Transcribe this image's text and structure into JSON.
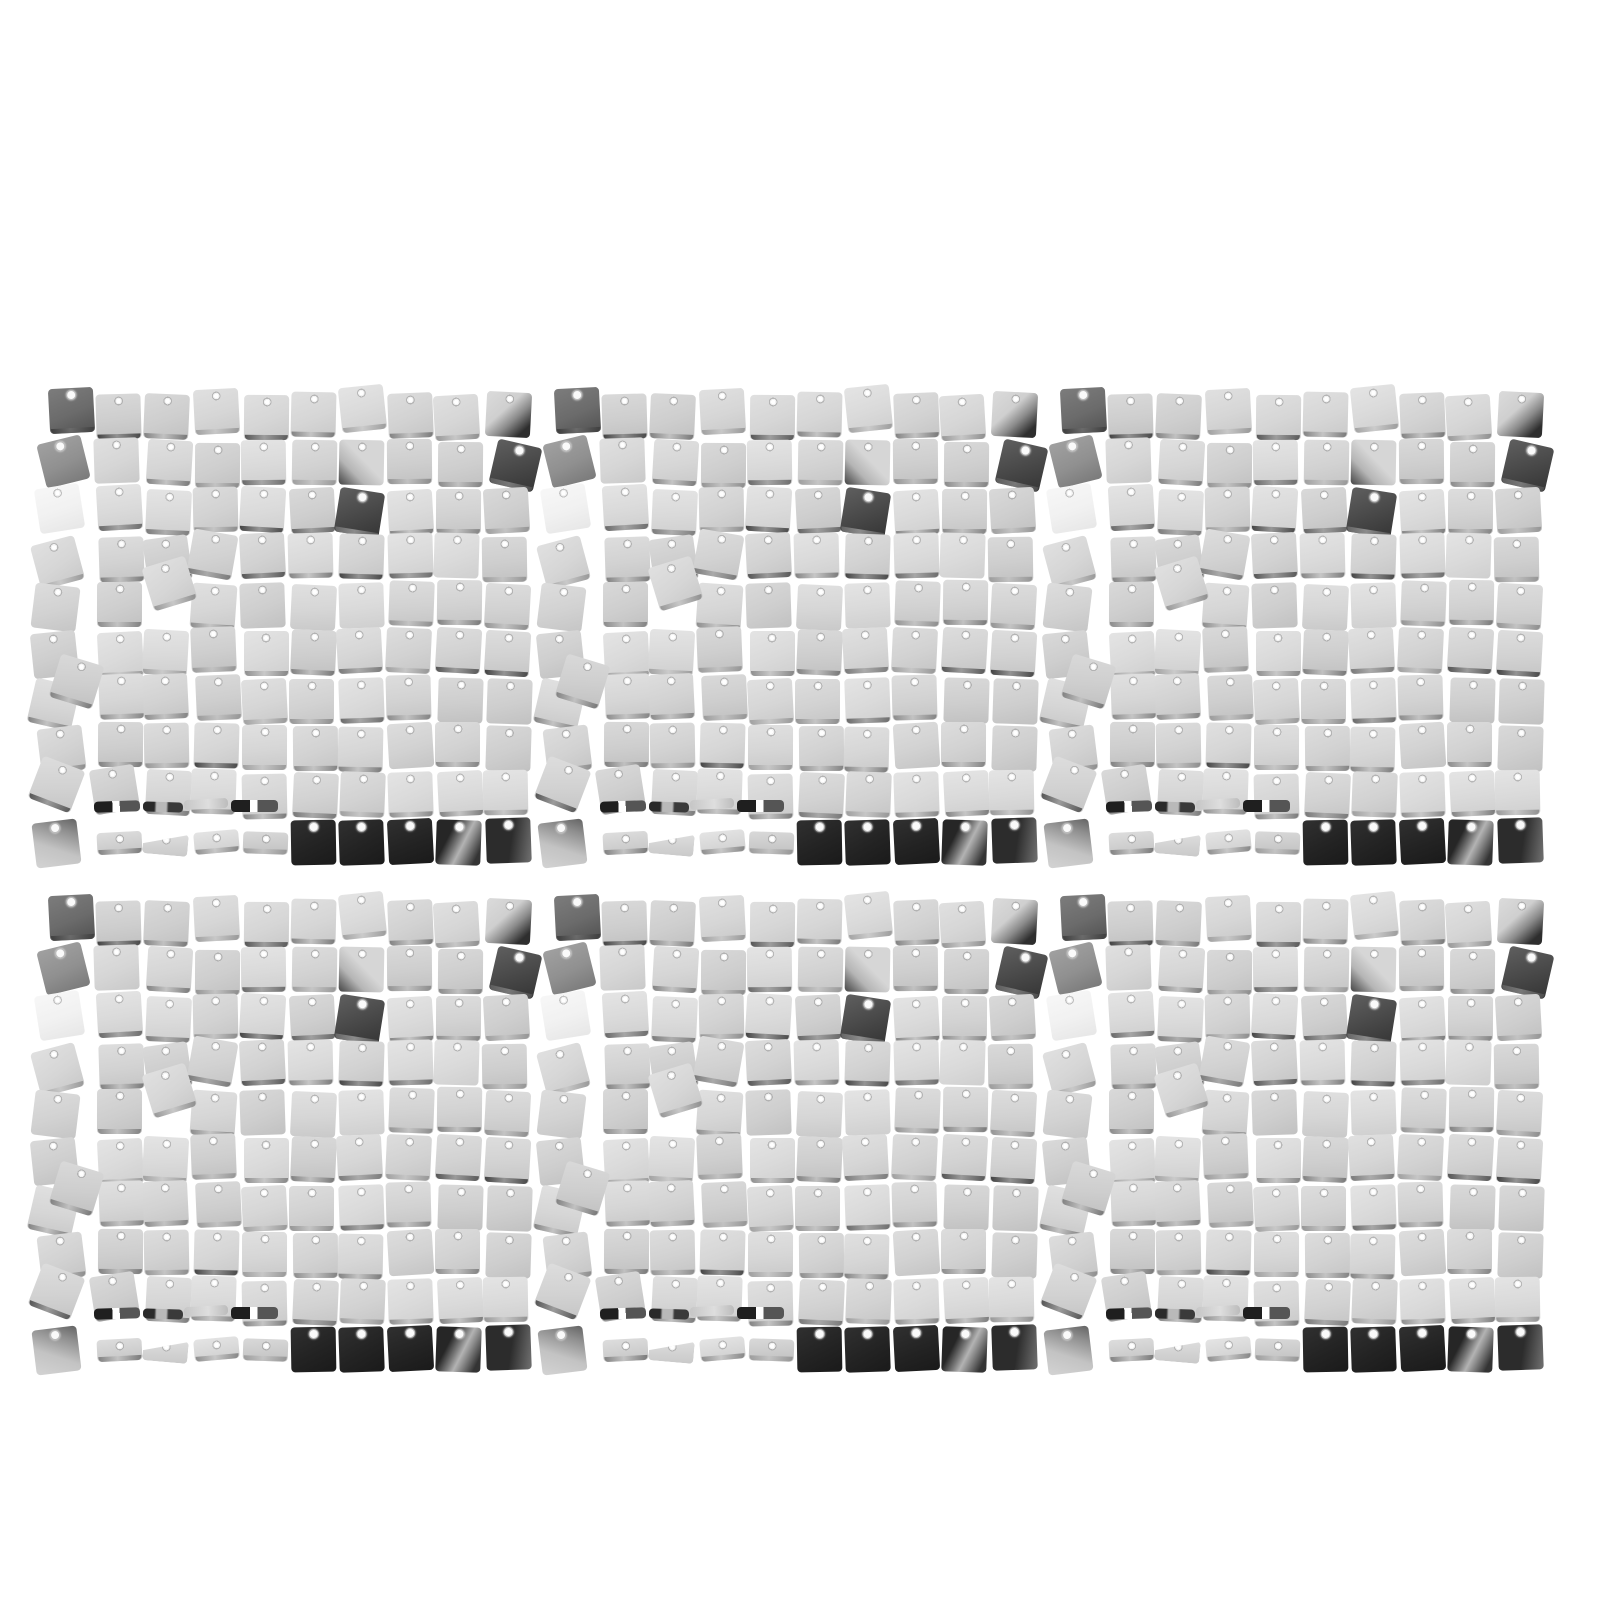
{
  "scene": {
    "subject": "six-silver-square-sequin-shimmer-wall-panels",
    "background_color": "#ffffff",
    "panels": {
      "count": 6,
      "arrangement_rows": 2,
      "arrangement_cols": 3,
      "origins_x": [
        48,
        554,
        1060
      ],
      "origins_y": [
        393,
        900
      ],
      "sequin_rows": 10,
      "sequin_cols": 10,
      "col_pitch": 48.5,
      "row_pitch": 47.3,
      "sequin_size": 45,
      "half_piece_height": 22,
      "sliver_height": 11
    },
    "colors": {
      "light_tints": [
        [
          "#e0e0e0",
          "#d6d6d6",
          "#c9c9c9"
        ],
        [
          "#dddddd",
          "#d2d2d2",
          "#c5c5c5"
        ],
        [
          "#e4e4e4",
          "#dadada",
          "#cfcfcf"
        ],
        [
          "#d9d9d9",
          "#cecece",
          "#c1c1c1"
        ]
      ],
      "white_tint": [
        "#f7f7f7",
        "#f1f1f1",
        "#e7e7e7"
      ],
      "mid_gray": [
        "#a0a0a0",
        "#909090",
        "#7a7a7a"
      ],
      "dark_gray": [
        "#7c7c7c",
        "#6b6b6b",
        "#525252"
      ],
      "dark_gray2": [
        "#5f5f5f",
        "#484848",
        "#353535"
      ],
      "black": [
        "#303030",
        "#232323",
        "#1a1a1a"
      ],
      "black_gradient": [
        "#262626",
        "#7e7e7e",
        "#b3b3b3",
        "#8a8a8a",
        "#343434"
      ],
      "black_side": [
        "#2c2c2c",
        "#6a6a6a"
      ],
      "grad_bottom_right": [
        "#dbdbdb",
        "#cfcfcf",
        "#8a8a8a",
        "#2e2e2e"
      ],
      "grad_bottom_left": [
        "#454545",
        "#6f6f6f",
        "#b5b5b5",
        "#d6d6d6"
      ],
      "grad_top_dark": [
        "#636363",
        "#8f8f8f",
        "#c3c3c3",
        "#d3d3d3"
      ],
      "sliver_dark": [
        "#1f1f1f",
        "#555555",
        "#262626"
      ],
      "sliver_mix": [
        "#2a2a2a",
        "#b9b9b9",
        "#3a3a3a"
      ],
      "sliver_light": [
        "#c6c6c6",
        "#dedede",
        "#bcbcbc"
      ],
      "edge_silver": [
        "rgba(110,110,110,0.85)",
        "rgba(190,190,190,0.65)",
        "rgba(95,95,95,0.8)"
      ],
      "edge_dark": [
        "rgba(40,40,40,0.9)",
        "rgba(120,120,120,0.7)",
        "rgba(50,50,50,0.9)"
      ]
    },
    "special_cells": [
      {
        "r": 1,
        "c": 1,
        "t": "dark",
        "rot": -3,
        "dx": 1,
        "dy": -5
      },
      {
        "r": 2,
        "c": 1,
        "t": "mid",
        "rot": -14,
        "dx": -7,
        "dy": -1
      },
      {
        "r": 3,
        "c": 1,
        "t": "white",
        "rot": -9,
        "dx": -11,
        "dy": -2
      },
      {
        "r": 4,
        "c": 1,
        "t": "light",
        "rot": -15,
        "dx": -13,
        "dy": 5
      },
      {
        "r": 5,
        "c": 1,
        "t": "light",
        "rot": 7,
        "dx": -15,
        "dy": 3
      },
      {
        "r": 6,
        "c": 1,
        "t": "light",
        "rot": -6,
        "dx": -16,
        "dy": 2
      },
      {
        "r": 7,
        "c": 1,
        "t": "light",
        "rot": 13,
        "dx": -17,
        "dy": 5
      },
      {
        "r": 8,
        "c": 1,
        "t": "light",
        "rot": -7,
        "dx": -9,
        "dy": 3
      },
      {
        "r": 9,
        "c": 1,
        "t": "light",
        "rot": 21,
        "dx": -14,
        "dy": -9
      },
      {
        "r": 9,
        "c": 2,
        "t": "light",
        "rot": -9,
        "dx": -5,
        "dy": -4
      },
      {
        "r": 10,
        "c": 1,
        "t": "grad-top",
        "rot": -7,
        "dx": -14,
        "dy": 2
      },
      {
        "r": 1,
        "c": 4,
        "t": "light",
        "rot": -3,
        "dx": 0,
        "dy": -4
      },
      {
        "r": 1,
        "c": 7,
        "t": "light",
        "rot": -6,
        "dx": 1,
        "dy": -7
      },
      {
        "r": 1,
        "c": 10,
        "t": "grad-br",
        "rot": 3,
        "dx": 1,
        "dy": -1
      },
      {
        "r": 2,
        "c": 7,
        "t": "grad-bl",
        "rot": 1,
        "dx": 0,
        "dy": 0
      },
      {
        "r": 2,
        "c": 10,
        "t": "dark2",
        "rot": 13,
        "dx": 8,
        "dy": 3
      },
      {
        "r": 3,
        "c": 7,
        "t": "dark2",
        "rot": 9,
        "dx": -2,
        "dy": 2
      },
      {
        "r": 4,
        "c": 3,
        "t": "light",
        "rot": -8,
        "dx": 0,
        "dy": 2
      },
      {
        "r": 4,
        "c": 4,
        "t": "light",
        "rot": 10,
        "dx": -4,
        "dy": -3
      },
      {
        "r": 5,
        "c": 3,
        "t": "gap"
      },
      {
        "r": 5,
        "c": 4,
        "t": "light",
        "rot": 4,
        "dx": -3,
        "dy": 2
      },
      {
        "r": 10,
        "c": 2,
        "t": "half",
        "rot": -3,
        "dx": 0,
        "dy": 0
      },
      {
        "r": 10,
        "c": 3,
        "t": "half-wedge",
        "rot": 5,
        "dx": -2,
        "dy": 1
      },
      {
        "r": 10,
        "c": 4,
        "t": "half",
        "rot": -5,
        "dx": 0,
        "dy": -1
      },
      {
        "r": 10,
        "c": 5,
        "t": "half",
        "rot": 2,
        "dx": 1,
        "dy": 0
      },
      {
        "r": 10,
        "c": 6,
        "t": "black",
        "rot": -1,
        "dx": 0,
        "dy": 1
      },
      {
        "r": 10,
        "c": 7,
        "t": "black",
        "rot": -2,
        "dx": 0,
        "dy": 1
      },
      {
        "r": 10,
        "c": 8,
        "t": "black",
        "rot": -3,
        "dx": 0,
        "dy": 0
      },
      {
        "r": 10,
        "c": 9,
        "t": "black-grad",
        "rot": 2,
        "dx": 0,
        "dy": 1
      },
      {
        "r": 10,
        "c": 10,
        "t": "black-side",
        "rot": -2,
        "dx": 1,
        "dy": -1
      }
    ],
    "extras": [
      {
        "col": 3.05,
        "row": 4.55,
        "t": "light",
        "rot": -17,
        "w": 45,
        "h": 45,
        "hole": true
      },
      {
        "col": 1.12,
        "row": 6.62,
        "t": "light",
        "rot": 17,
        "w": 45,
        "h": 45,
        "hole": true
      },
      {
        "col": 1.95,
        "row": 9.62,
        "t": "sliver-notch",
        "rot": -2,
        "w": 46,
        "h": 11,
        "hole": false
      },
      {
        "col": 2.95,
        "row": 9.64,
        "t": "sliver-mix",
        "rot": 2,
        "w": 40,
        "h": 10,
        "hole": false
      },
      {
        "col": 3.8,
        "row": 9.58,
        "t": "sliver-light",
        "rot": -3,
        "w": 44,
        "h": 10,
        "hole": false
      },
      {
        "col": 4.78,
        "row": 9.6,
        "t": "sliver-notch",
        "rot": 0,
        "w": 47,
        "h": 12,
        "hole": false
      }
    ]
  }
}
